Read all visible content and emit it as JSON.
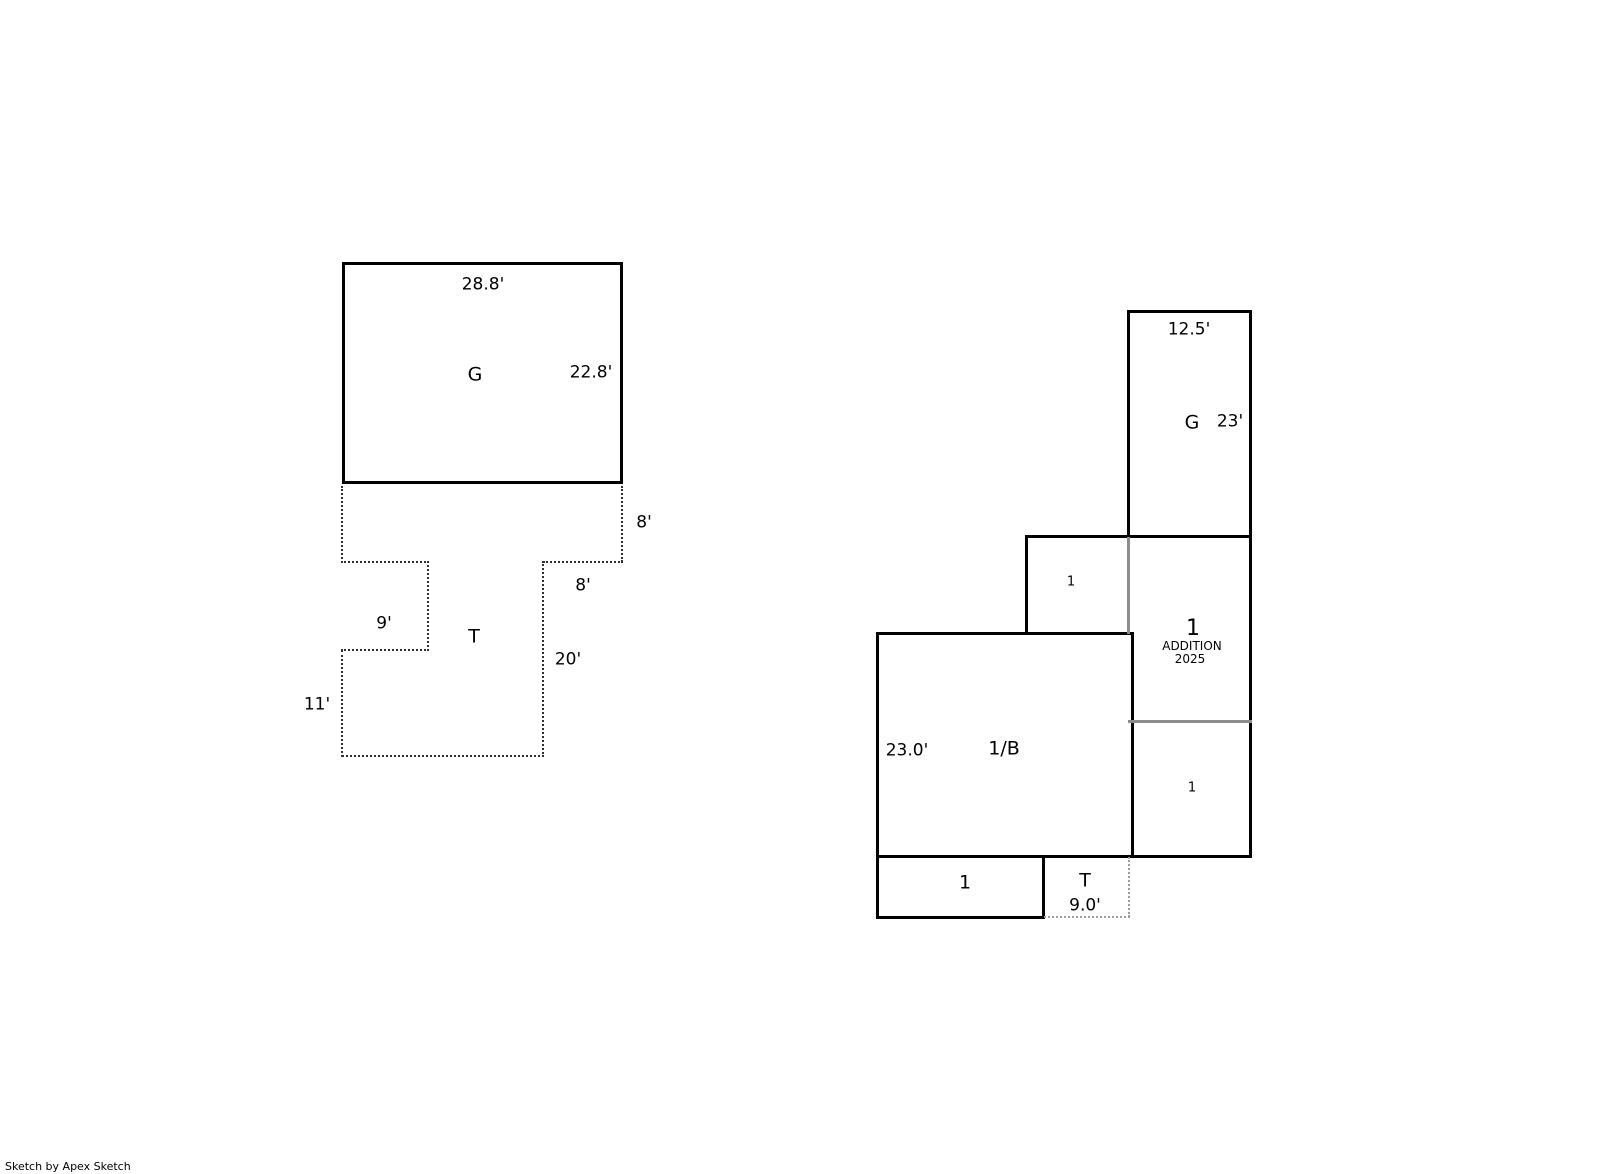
{
  "left_sketch": {
    "garage_area": "G",
    "garage_width": "28.8'",
    "garage_depth": "22.8'",
    "terrace_area": "T",
    "terrace_right_dim": "8'",
    "terrace_inner_dim": "8'",
    "terrace_stem_dim": "20'",
    "terrace_notch_dim": "9'",
    "terrace_left_dim": "11'"
  },
  "right_sketch": {
    "garage_area": "G",
    "garage_width": "12.5'",
    "garage_depth": "23'",
    "upper_story": "1",
    "addition_story": "1",
    "addition_label": "ADDITION",
    "addition_year": "2025",
    "main_area": "1/B",
    "main_depth": "23.0'",
    "right_story": "1",
    "bottom_story": "1",
    "terrace_area": "T",
    "terrace_width": "9.0'"
  },
  "credit": "Sketch by Apex Sketch",
  "colors": {
    "line": "#000000",
    "overlap_line": "#8c8c8c",
    "background": "#ffffff"
  }
}
